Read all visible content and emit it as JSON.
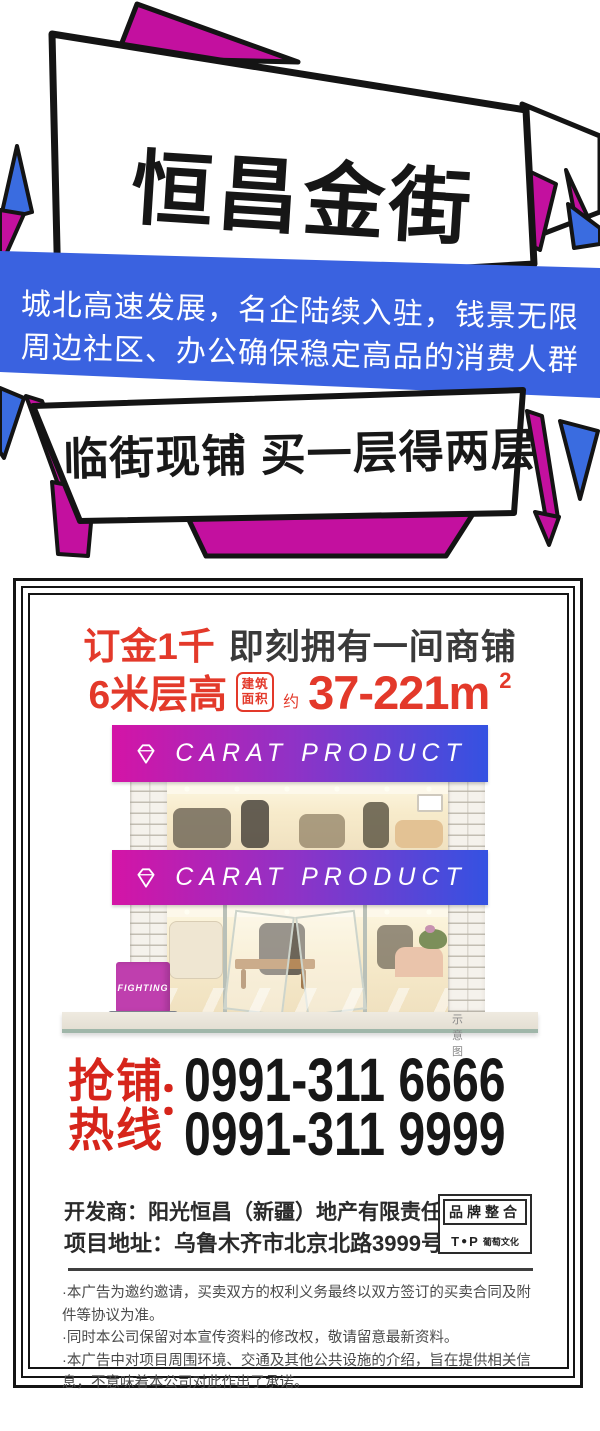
{
  "top": {
    "title": "恒昌金街",
    "banner_line1": "城北高速发展，名企陆续入驻，钱景无限",
    "banner_line2": "周边社区、办公确保稳定高品的消费人群",
    "slogan": "临街现铺 买一层得两层"
  },
  "offer": {
    "deposit_highlight": "订金1千",
    "deposit_rest": "即刻拥有一间商铺",
    "floor_height": "6米层高",
    "area_stamp_line1": "建筑",
    "area_stamp_line2": "面积",
    "approx": "约",
    "area_value": "37-221m",
    "area_sup": "2"
  },
  "storefront": {
    "sign_text": "CARAT PRODUCT",
    "side_sign": "FIGHTING",
    "caption": "示意图"
  },
  "hotline": {
    "label_line1": "抢铺",
    "label_line2": "热线",
    "colon": "：",
    "phone1": "0991-311 6666",
    "phone2": "0991-311 9999"
  },
  "developer": {
    "line1": "开发商：阳光恒昌（新疆）地产有限责任公司",
    "line2": "项目地址：乌鲁木齐市北京北路3999号"
  },
  "brand_box": {
    "top": "品牌整合",
    "logo_t": "T",
    "logo_o": "●",
    "logo_p": "P",
    "name": "葡萄文化"
  },
  "disclaimer": {
    "lines": [
      "·本广告为邀约邀请，买卖双方的权利义务最终以双方签订的买卖合同及附件等协议为准。",
      "·同时本公司保留对本宣传资料的修改权，敬请留意最新资料。",
      "·本广告中对项目周围环境、交通及其他公共设施的介绍，旨在提供相关信息，不意味着本公司对此作出了承诺。"
    ]
  },
  "colors": {
    "magenta": "#c3109f",
    "blue": "#3a62e0",
    "red": "#e3392a",
    "hotline_red": "#d6251b",
    "sign_gradient_left": "#d414a6",
    "sign_gradient_right": "#3452e2"
  }
}
